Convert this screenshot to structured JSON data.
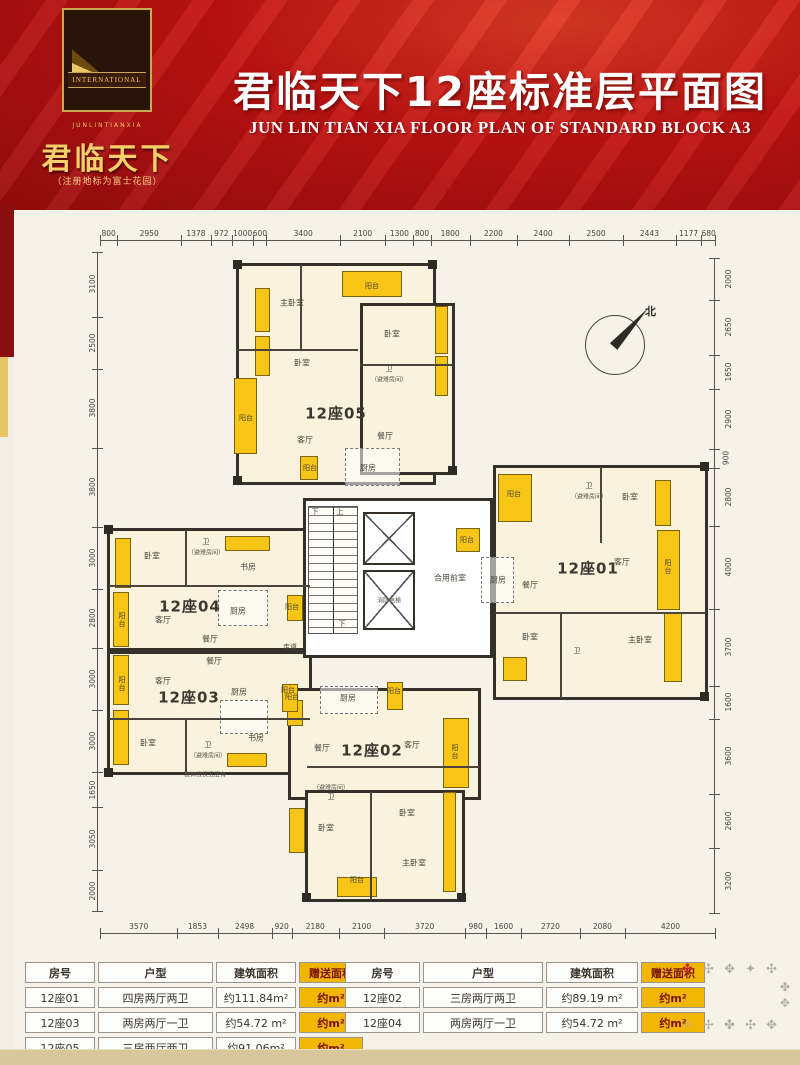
{
  "header": {
    "title": "君临天下12座标准层平面图",
    "subtitle": "JUN LIN TIAN XIA FLOOR PLAN OF STANDARD BLOCK A3",
    "logo": {
      "emblem_band": "INTERNATIONAL",
      "small_line": "JUNLINTIANXIA",
      "brand": "君临天下",
      "brand_note": "（注册地标为富士花园）"
    }
  },
  "plan": {
    "compass_label": "北",
    "dims": {
      "top": [
        "800",
        "2950",
        "1378",
        "972",
        "1000",
        "600",
        "3400",
        "2100",
        "1300",
        "800",
        "1800",
        "2200",
        "2400",
        "2500",
        "2443",
        "1177",
        "680"
      ],
      "bottom": [
        "3570",
        "1853",
        "2498",
        "920",
        "2180",
        "2100",
        "3720",
        "980",
        "1600",
        "2720",
        "2080",
        "4200"
      ],
      "left": [
        "3100",
        "2500",
        "3800",
        "3800",
        "3000",
        "2800",
        "3000",
        "3000",
        "1650",
        "3050",
        "2000"
      ],
      "right": [
        "2000",
        "2650",
        "1650",
        "2900",
        "900",
        "2800",
        "4000",
        "3700",
        "1600",
        "3600",
        "2600",
        "3200"
      ]
    },
    "core_labels": {
      "stair_down_top": "下",
      "stair_up": "上",
      "stair_down_bottom": "下",
      "lobby": "合用前室",
      "fire_lift": "消防电梯",
      "corridor": "走道"
    },
    "note": "装饰线仅五层有",
    "labels": [
      {
        "t": "主卧室",
        "x": 292,
        "y": 303,
        "c": "r"
      },
      {
        "t": "阳台",
        "x": 372,
        "y": 286,
        "c": "s"
      },
      {
        "t": "卧室",
        "x": 392,
        "y": 334,
        "c": "r"
      },
      {
        "t": "卫",
        "x": 389,
        "y": 369,
        "c": "s"
      },
      {
        "t": "（避难房间）",
        "x": 389,
        "y": 379,
        "c": "n"
      },
      {
        "t": "卧室",
        "x": 302,
        "y": 363,
        "c": "r"
      },
      {
        "t": "阳台",
        "x": 246,
        "y": 418,
        "c": "s"
      },
      {
        "t": "12座05",
        "x": 336,
        "y": 413,
        "c": "u"
      },
      {
        "t": "客厅",
        "x": 305,
        "y": 440,
        "c": "r"
      },
      {
        "t": "餐厅",
        "x": 385,
        "y": 436,
        "c": "r"
      },
      {
        "t": "厨房",
        "x": 368,
        "y": 468,
        "c": "r"
      },
      {
        "t": "阳台",
        "x": 310,
        "y": 468,
        "c": "s"
      },
      {
        "t": "阳台",
        "x": 514,
        "y": 494,
        "c": "s"
      },
      {
        "t": "卫",
        "x": 589,
        "y": 486,
        "c": "s"
      },
      {
        "t": "（避难房间）",
        "x": 589,
        "y": 496,
        "c": "n"
      },
      {
        "t": "卧室",
        "x": 630,
        "y": 497,
        "c": "r"
      },
      {
        "t": "客厅",
        "x": 622,
        "y": 562,
        "c": "r"
      },
      {
        "t": "阳台",
        "x": 668,
        "y": 567,
        "c": "sv"
      },
      {
        "t": "厨房",
        "x": 498,
        "y": 580,
        "c": "r"
      },
      {
        "t": "餐厅",
        "x": 530,
        "y": 585,
        "c": "r"
      },
      {
        "t": "12座01",
        "x": 588,
        "y": 568,
        "c": "u"
      },
      {
        "t": "卧室",
        "x": 530,
        "y": 637,
        "c": "r"
      },
      {
        "t": "卫",
        "x": 577,
        "y": 651,
        "c": "s"
      },
      {
        "t": "主卧室",
        "x": 640,
        "y": 640,
        "c": "r"
      },
      {
        "t": "阳台",
        "x": 467,
        "y": 540,
        "c": "s"
      },
      {
        "t": "卧室",
        "x": 152,
        "y": 556,
        "c": "r"
      },
      {
        "t": "卫",
        "x": 206,
        "y": 542,
        "c": "s"
      },
      {
        "t": "（避难房间）",
        "x": 206,
        "y": 552,
        "c": "n"
      },
      {
        "t": "书房",
        "x": 248,
        "y": 567,
        "c": "r"
      },
      {
        "t": "12座04",
        "x": 190,
        "y": 606,
        "c": "u"
      },
      {
        "t": "客厅",
        "x": 163,
        "y": 620,
        "c": "r"
      },
      {
        "t": "厨房",
        "x": 238,
        "y": 611,
        "c": "r"
      },
      {
        "t": "阳台",
        "x": 292,
        "y": 607,
        "c": "s"
      },
      {
        "t": "阳台",
        "x": 122,
        "y": 620,
        "c": "sv"
      },
      {
        "t": "餐厅",
        "x": 210,
        "y": 639,
        "c": "r"
      },
      {
        "t": "餐厅",
        "x": 214,
        "y": 661,
        "c": "r"
      },
      {
        "t": "客厅",
        "x": 163,
        "y": 681,
        "c": "r"
      },
      {
        "t": "阳台",
        "x": 122,
        "y": 684,
        "c": "sv"
      },
      {
        "t": "12座03",
        "x": 189,
        "y": 697,
        "c": "u"
      },
      {
        "t": "厨房",
        "x": 239,
        "y": 692,
        "c": "r"
      },
      {
        "t": "阳台",
        "x": 292,
        "y": 697,
        "c": "s"
      },
      {
        "t": "卧室",
        "x": 148,
        "y": 743,
        "c": "r"
      },
      {
        "t": "卫",
        "x": 208,
        "y": 745,
        "c": "s"
      },
      {
        "t": "（避难房间）",
        "x": 208,
        "y": 755,
        "c": "n"
      },
      {
        "t": "书房",
        "x": 256,
        "y": 738,
        "c": "r"
      },
      {
        "t": "厨房",
        "x": 348,
        "y": 698,
        "c": "r"
      },
      {
        "t": "阳台",
        "x": 394,
        "y": 691,
        "c": "s"
      },
      {
        "t": "阳台",
        "x": 288,
        "y": 690,
        "c": "s"
      },
      {
        "t": "餐厅",
        "x": 322,
        "y": 748,
        "c": "r"
      },
      {
        "t": "12座02",
        "x": 372,
        "y": 750,
        "c": "u"
      },
      {
        "t": "客厅",
        "x": 412,
        "y": 745,
        "c": "r"
      },
      {
        "t": "阳台",
        "x": 455,
        "y": 752,
        "c": "sv"
      },
      {
        "t": "（避难房间）",
        "x": 331,
        "y": 787,
        "c": "n"
      },
      {
        "t": "卫",
        "x": 331,
        "y": 797,
        "c": "s"
      },
      {
        "t": "卧室",
        "x": 326,
        "y": 828,
        "c": "r"
      },
      {
        "t": "卧室",
        "x": 407,
        "y": 813,
        "c": "r"
      },
      {
        "t": "主卧室",
        "x": 414,
        "y": 863,
        "c": "r"
      },
      {
        "t": "阳台",
        "x": 357,
        "y": 880,
        "c": "s"
      }
    ]
  },
  "tables": {
    "headers": [
      "房号",
      "户型",
      "建筑面积",
      "赠送面积"
    ],
    "left_rows": [
      [
        "12座01",
        "四房两厅两卫",
        "约111.84m²",
        "约m²"
      ],
      [
        "12座03",
        "两房两厅一卫",
        "约54.72 m²",
        "约m²"
      ],
      [
        "12座05",
        "三房两厅两卫",
        "约91.06m²",
        "约m²"
      ]
    ],
    "right_rows": [
      [
        "12座02",
        "三房两厅两卫",
        "约89.19 m²",
        "约m²"
      ],
      [
        "12座04",
        "两房两厅一卫",
        "约54.72 m²",
        "约m²"
      ]
    ]
  },
  "ornaments": {
    "row1_first": "✤",
    "row1": "✣ ✥ ✦ ✣",
    "col": "✤✥",
    "row2": "✧ ✢ ✤ ✣ ✥"
  }
}
